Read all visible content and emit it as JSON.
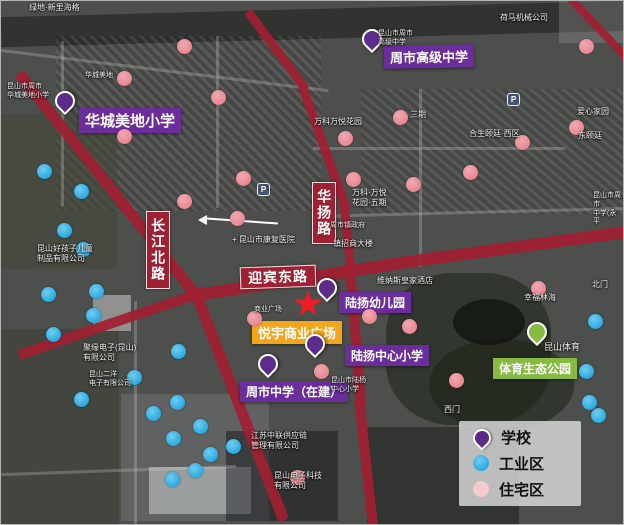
{
  "colors": {
    "road": "#a01f32",
    "school_purple": "#6b2d9b",
    "pin_purple": "#5d2b8c",
    "industrial_blue": "#2aaae2",
    "residential_pink": "#e8858f",
    "legend_pink": "#f4c9cf",
    "commercial_orange": "#f3a51c",
    "park_green": "#85bb40",
    "star_red": "#ee1c25"
  },
  "roads": {
    "changjiang": "长江北路",
    "huayang": "华扬路",
    "yingbin": "迎宾东路"
  },
  "pois": {
    "huacheng": {
      "label": "华城美地小学",
      "type": "school"
    },
    "zhoushi_gaoji": {
      "label": "周市高级中学",
      "type": "school"
    },
    "luyang_kinder": {
      "label": "陆扬幼儿园",
      "type": "school"
    },
    "luyang_primary": {
      "label": "陆扬中心小学",
      "type": "school"
    },
    "zhoushi_middle": {
      "label": "周市中学（在建）",
      "type": "school"
    },
    "yueyu": {
      "label": "悦宇商业广场",
      "type": "commercial"
    },
    "sports_park": {
      "label": "体育生态公园",
      "type": "park"
    }
  },
  "legend": {
    "school": "学校",
    "industrial": "工业区",
    "residential": "住宅区"
  },
  "markers": {
    "school_pins": [
      {
        "x": 64,
        "y": 100,
        "poi": "huacheng"
      },
      {
        "x": 371,
        "y": 38,
        "poi": "zhoushi_gaoji"
      },
      {
        "x": 326,
        "y": 287,
        "poi": "luyang_kinder"
      },
      {
        "x": 314,
        "y": 343,
        "poi": "luyang_primary"
      },
      {
        "x": 267,
        "y": 363,
        "poi": "zhoushi_middle"
      }
    ],
    "park_pin": {
      "x": 536,
      "y": 331,
      "poi": "sports_park"
    },
    "star": {
      "x": 307,
      "y": 303,
      "poi": "yueyu"
    },
    "industrial": [
      [
        43,
        170
      ],
      [
        80,
        190
      ],
      [
        63,
        229
      ],
      [
        82,
        248
      ],
      [
        47,
        293
      ],
      [
        95,
        290
      ],
      [
        92,
        314
      ],
      [
        52,
        333
      ],
      [
        133,
        376
      ],
      [
        80,
        398
      ],
      [
        177,
        350
      ],
      [
        152,
        412
      ],
      [
        176,
        401
      ],
      [
        172,
        437
      ],
      [
        199,
        425
      ],
      [
        209,
        453
      ],
      [
        232,
        445
      ],
      [
        194,
        469
      ],
      [
        171,
        478
      ],
      [
        594,
        320
      ],
      [
        585,
        370
      ],
      [
        588,
        401
      ],
      [
        597,
        414
      ]
    ],
    "residential": [
      [
        183,
        45
      ],
      [
        123,
        77
      ],
      [
        217,
        96
      ],
      [
        123,
        135
      ],
      [
        242,
        177
      ],
      [
        183,
        200
      ],
      [
        236,
        217
      ],
      [
        585,
        45
      ],
      [
        399,
        116
      ],
      [
        344,
        137
      ],
      [
        521,
        141
      ],
      [
        575,
        126
      ],
      [
        352,
        178
      ],
      [
        412,
        183
      ],
      [
        469,
        171
      ],
      [
        537,
        287
      ],
      [
        368,
        315
      ],
      [
        408,
        325
      ],
      [
        455,
        379
      ],
      [
        320,
        370
      ],
      [
        253,
        317
      ],
      [
        296,
        476
      ]
    ]
  },
  "map_texts": [
    {
      "x": 28,
      "y": 2,
      "t": "绿地·新里海格"
    },
    {
      "x": 6,
      "y": 82,
      "t": "昆山市周市\n华城美地小学",
      "s": 7
    },
    {
      "x": 84,
      "y": 71,
      "t": "华城美地",
      "s": 7
    },
    {
      "x": 377,
      "y": 29,
      "t": "昆山市周市\n高级中学",
      "s": 7
    },
    {
      "x": 499,
      "y": 12,
      "t": "荷马机械公司"
    },
    {
      "x": 313,
      "y": 116,
      "t": "万科万悦花园"
    },
    {
      "x": 409,
      "y": 109,
      "t": "三期"
    },
    {
      "x": 468,
      "y": 128,
      "t": "合生颐廷·西区"
    },
    {
      "x": 576,
      "y": 106,
      "t": "爱心家园"
    },
    {
      "x": 577,
      "y": 130,
      "t": "东颐廷"
    },
    {
      "x": 351,
      "y": 187,
      "t": "万科·万悦\n花园·五期"
    },
    {
      "x": 231,
      "y": 234,
      "t": "+ 昆山市康复医院"
    },
    {
      "x": 329,
      "y": 221,
      "t": "周市镇政府",
      "s": 7
    },
    {
      "x": 332,
      "y": 238,
      "t": "镇招商大楼"
    },
    {
      "x": 376,
      "y": 275,
      "t": "维纳斯皇家酒店"
    },
    {
      "x": 523,
      "y": 292,
      "t": "幸福林海"
    },
    {
      "x": 591,
      "y": 279,
      "t": "北门"
    },
    {
      "x": 543,
      "y": 341,
      "t": "昆山体育",
      "s": 9
    },
    {
      "x": 443,
      "y": 404,
      "t": "西门"
    },
    {
      "x": 82,
      "y": 342,
      "t": "聚缘电子(昆山)\n有限公司"
    },
    {
      "x": 88,
      "y": 370,
      "t": "昆山二洋\n电子有限公司",
      "s": 7
    },
    {
      "x": 36,
      "y": 243,
      "t": "昆山好孩子儿童\n制品有限公司"
    },
    {
      "x": 250,
      "y": 430,
      "t": "江苏中联供应链\n管理有限公司"
    },
    {
      "x": 273,
      "y": 470,
      "t": "昆山电子科技\n有限公司"
    },
    {
      "x": 592,
      "y": 191,
      "t": "昆山市周市\n中学(永平",
      "s": 7
    },
    {
      "x": 253,
      "y": 305,
      "t": "商业广场",
      "s": 7
    },
    {
      "x": 330,
      "y": 376,
      "t": "昆山市陆杨\n中心小学",
      "s": 7
    }
  ],
  "p_icons": [
    {
      "x": 256,
      "y": 182,
      "t": "P"
    },
    {
      "x": 506,
      "y": 92,
      "t": "P"
    }
  ]
}
